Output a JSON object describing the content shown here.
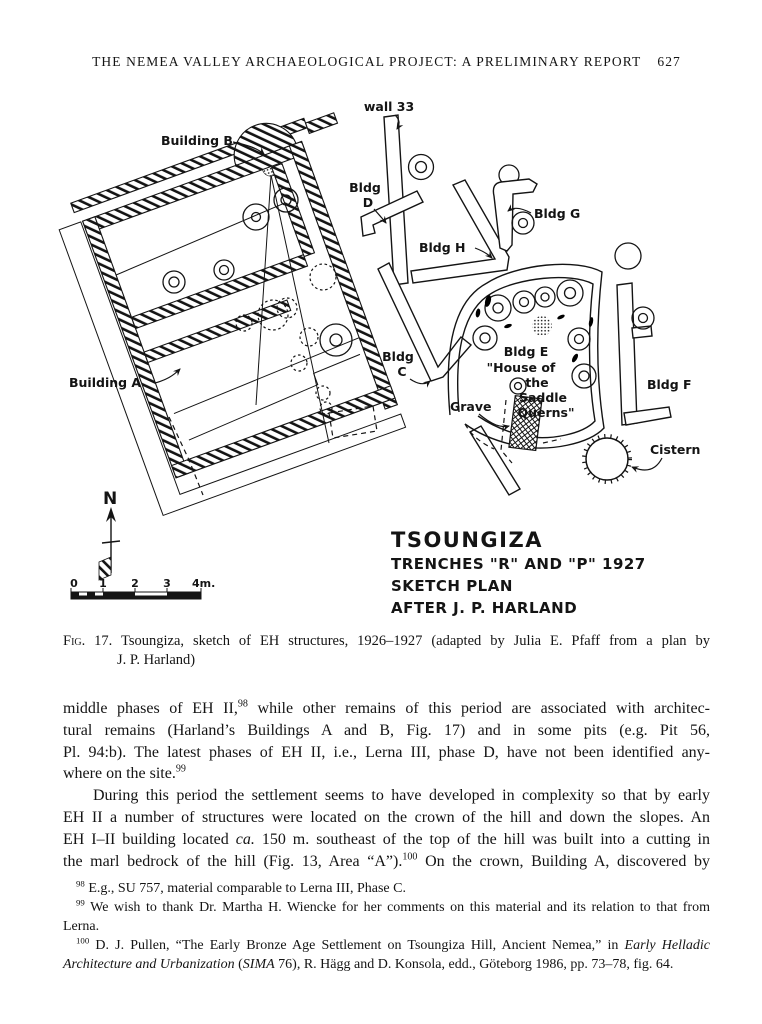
{
  "header": {
    "title": "THE NEMEA VALLEY ARCHAEOLOGICAL PROJECT: A PRELIMINARY REPORT",
    "page_number": "627"
  },
  "figure": {
    "labels": {
      "building_b": "Building B",
      "wall_33": "wall 33",
      "bldg_d_line1": "Bldg",
      "bldg_d_line2": "D",
      "bldg_g": "Bldg G",
      "bldg_h": "Bldg H",
      "building_a": "Building A",
      "bldg_c_line1": "Bldg",
      "bldg_c_line2": "C",
      "bldg_e_line1": "Bldg E",
      "bldg_e_line2": "\"House of",
      "bldg_e_line3": "the",
      "bldg_e_line4": "Saddle",
      "bldg_e_line5": "Querns\"",
      "grave": "Grave",
      "cistern": "Cistern",
      "bldg_f": "Bldg F",
      "north": "N"
    },
    "scale_bar": {
      "t0": "0",
      "t1": "1",
      "t2": "2",
      "t3": "3",
      "t4": "4m."
    },
    "title_block": {
      "line1": "TSOUNGIZA",
      "line2": "TRENCHES \"R\" AND \"P\" 1927",
      "line3": "SKETCH PLAN",
      "line4": "AFTER J. P. HARLAND"
    }
  },
  "caption": {
    "lines": [
      {
        "seg": [
          {
            "t": "Fig. 17.",
            "sc": true
          },
          {
            "t": " Tsoungiza, sketch of EH structures, 1926–1927 (adapted by Julia E. Pfaff from a plan by"
          }
        ]
      },
      {
        "seg": [
          {
            "t": "J. P. Harland)"
          }
        ],
        "indent": 54,
        "last": true
      }
    ]
  },
  "body": {
    "para1": [
      {
        "seg": [
          {
            "t": "middle phases of EH II,"
          },
          {
            "t": "98",
            "sup": true
          },
          {
            "t": " while other remains of this period are associated with architec-"
          }
        ]
      },
      {
        "seg": [
          {
            "t": "tural remains (Harland’s Buildings A and B, Fig. 17) and in some pits (e.g. Pit 56,"
          }
        ]
      },
      {
        "seg": [
          {
            "t": "Pl. 94:b). The latest phases of EH II, i.e., Lerna III, phase D, have not been identified any-"
          }
        ]
      },
      {
        "seg": [
          {
            "t": "where on the site."
          },
          {
            "t": "99",
            "sup": true
          }
        ],
        "last": true
      }
    ],
    "para2": [
      {
        "seg": [
          {
            "t": "During this period the settlement seems to have developed in complexity so that by early"
          }
        ],
        "indent": 30
      },
      {
        "seg": [
          {
            "t": "EH II a number of structures were located on the crown of the hill and down the slopes. An"
          }
        ]
      },
      {
        "seg": [
          {
            "t": "EH I–II building located "
          },
          {
            "t": "ca.",
            "i": true
          },
          {
            "t": " 150 m. southeast of the top of the hill was built into a cutting in"
          }
        ]
      },
      {
        "seg": [
          {
            "t": "the marl bedrock of the hill (Fig. 13, Area “A”)."
          },
          {
            "t": "100",
            "sup": true
          },
          {
            "t": " On the crown, Building A, discovered by"
          }
        ]
      }
    ]
  },
  "footnotes": {
    "fn98": [
      {
        "seg": [
          {
            "t": "98",
            "sup": true
          },
          {
            "t": " E.g., SU 757, material comparable to Lerna III, Phase C."
          }
        ],
        "indent": 13,
        "last": true
      }
    ],
    "fn99": [
      {
        "seg": [
          {
            "t": "99",
            "sup": true
          },
          {
            "t": " We wish to thank Dr. Martha H. Wiencke for her comments on this material and its relation to that from"
          }
        ],
        "indent": 13
      },
      {
        "seg": [
          {
            "t": "Lerna."
          }
        ],
        "last": true
      }
    ],
    "fn100": [
      {
        "seg": [
          {
            "t": "100",
            "sup": true
          },
          {
            "t": " D. J. Pullen, “The Early Bronze Age Settlement on Tsoungiza Hill, Ancient Nemea,” in "
          },
          {
            "t": "Early Helladic",
            "i": true
          }
        ],
        "indent": 13
      },
      {
        "seg": [
          {
            "t": "Architecture and Urbanization",
            "i": true
          },
          {
            "t": " ("
          },
          {
            "t": "SIMA",
            "i": true
          },
          {
            "t": " 76), R. Hägg and D. Konsola, edd., Göteborg 1986, pp. 73–78, fig. 64."
          }
        ],
        "last": true
      }
    ]
  }
}
